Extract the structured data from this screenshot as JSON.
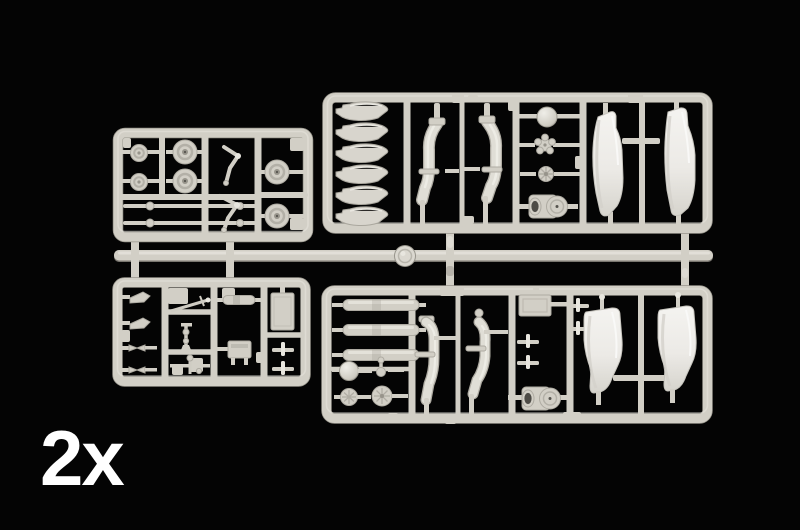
{
  "scene": {
    "quantity_label": "2x",
    "sprues": [
      {
        "id": "top-left",
        "name": "wheels and landing gear sprue"
      },
      {
        "id": "top-right",
        "name": "rotor blades, intake ducts and white fuselage halves sprue"
      },
      {
        "id": "bottom-left",
        "name": "small detail parts sprue"
      },
      {
        "id": "bottom-right",
        "name": "tanks, exhaust ducts and white tail halves sprue"
      }
    ],
    "runner_name": "central runner bar"
  },
  "colors": {
    "background": "#040404",
    "sprue": "#d2cfc6",
    "sprue_light": "#e8e6df",
    "sprue_dark": "#97948b",
    "sprue_edge": "#aeaba2",
    "part_white": "#eceae6",
    "part_edge": "#c6c4bd",
    "label": "#ffffff"
  }
}
